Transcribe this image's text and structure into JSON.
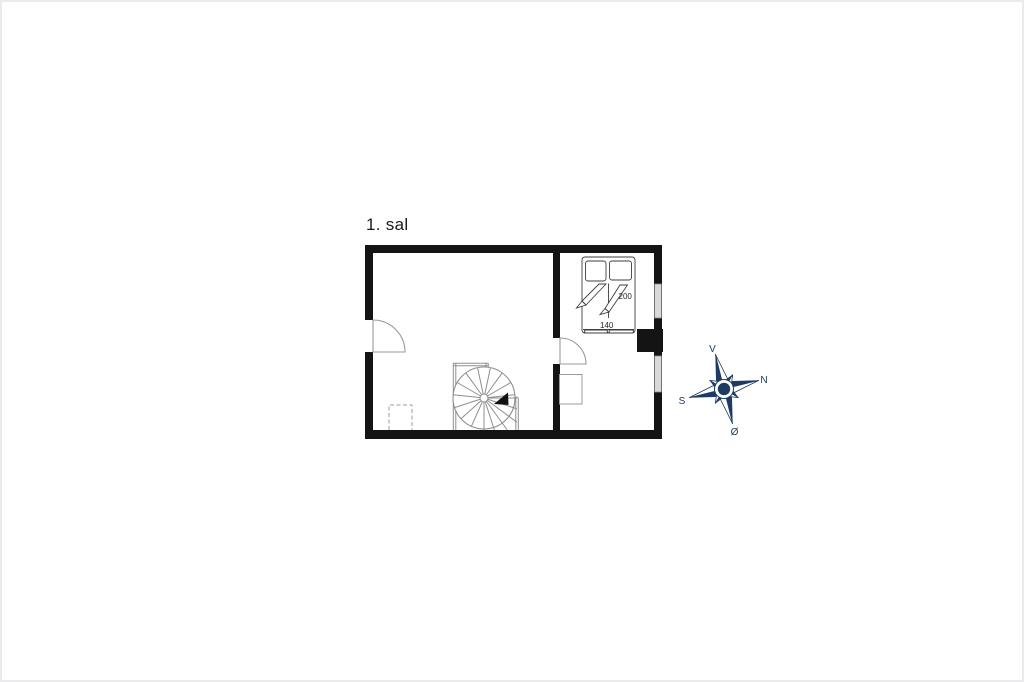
{
  "page": {
    "background": "#ffffff",
    "border_color": "#ebebed"
  },
  "floor_plan": {
    "title": "1. sal",
    "bed": {
      "length_label": "200",
      "width_label": "140"
    },
    "colors": {
      "wall": "#141414",
      "window_fill": "#d9d9d9",
      "outline": "#8f8f8f"
    }
  },
  "compass": {
    "color": "#1e3c63",
    "labels": {
      "top": "V",
      "right": "N",
      "left": "S",
      "bottom": "Ø"
    }
  }
}
